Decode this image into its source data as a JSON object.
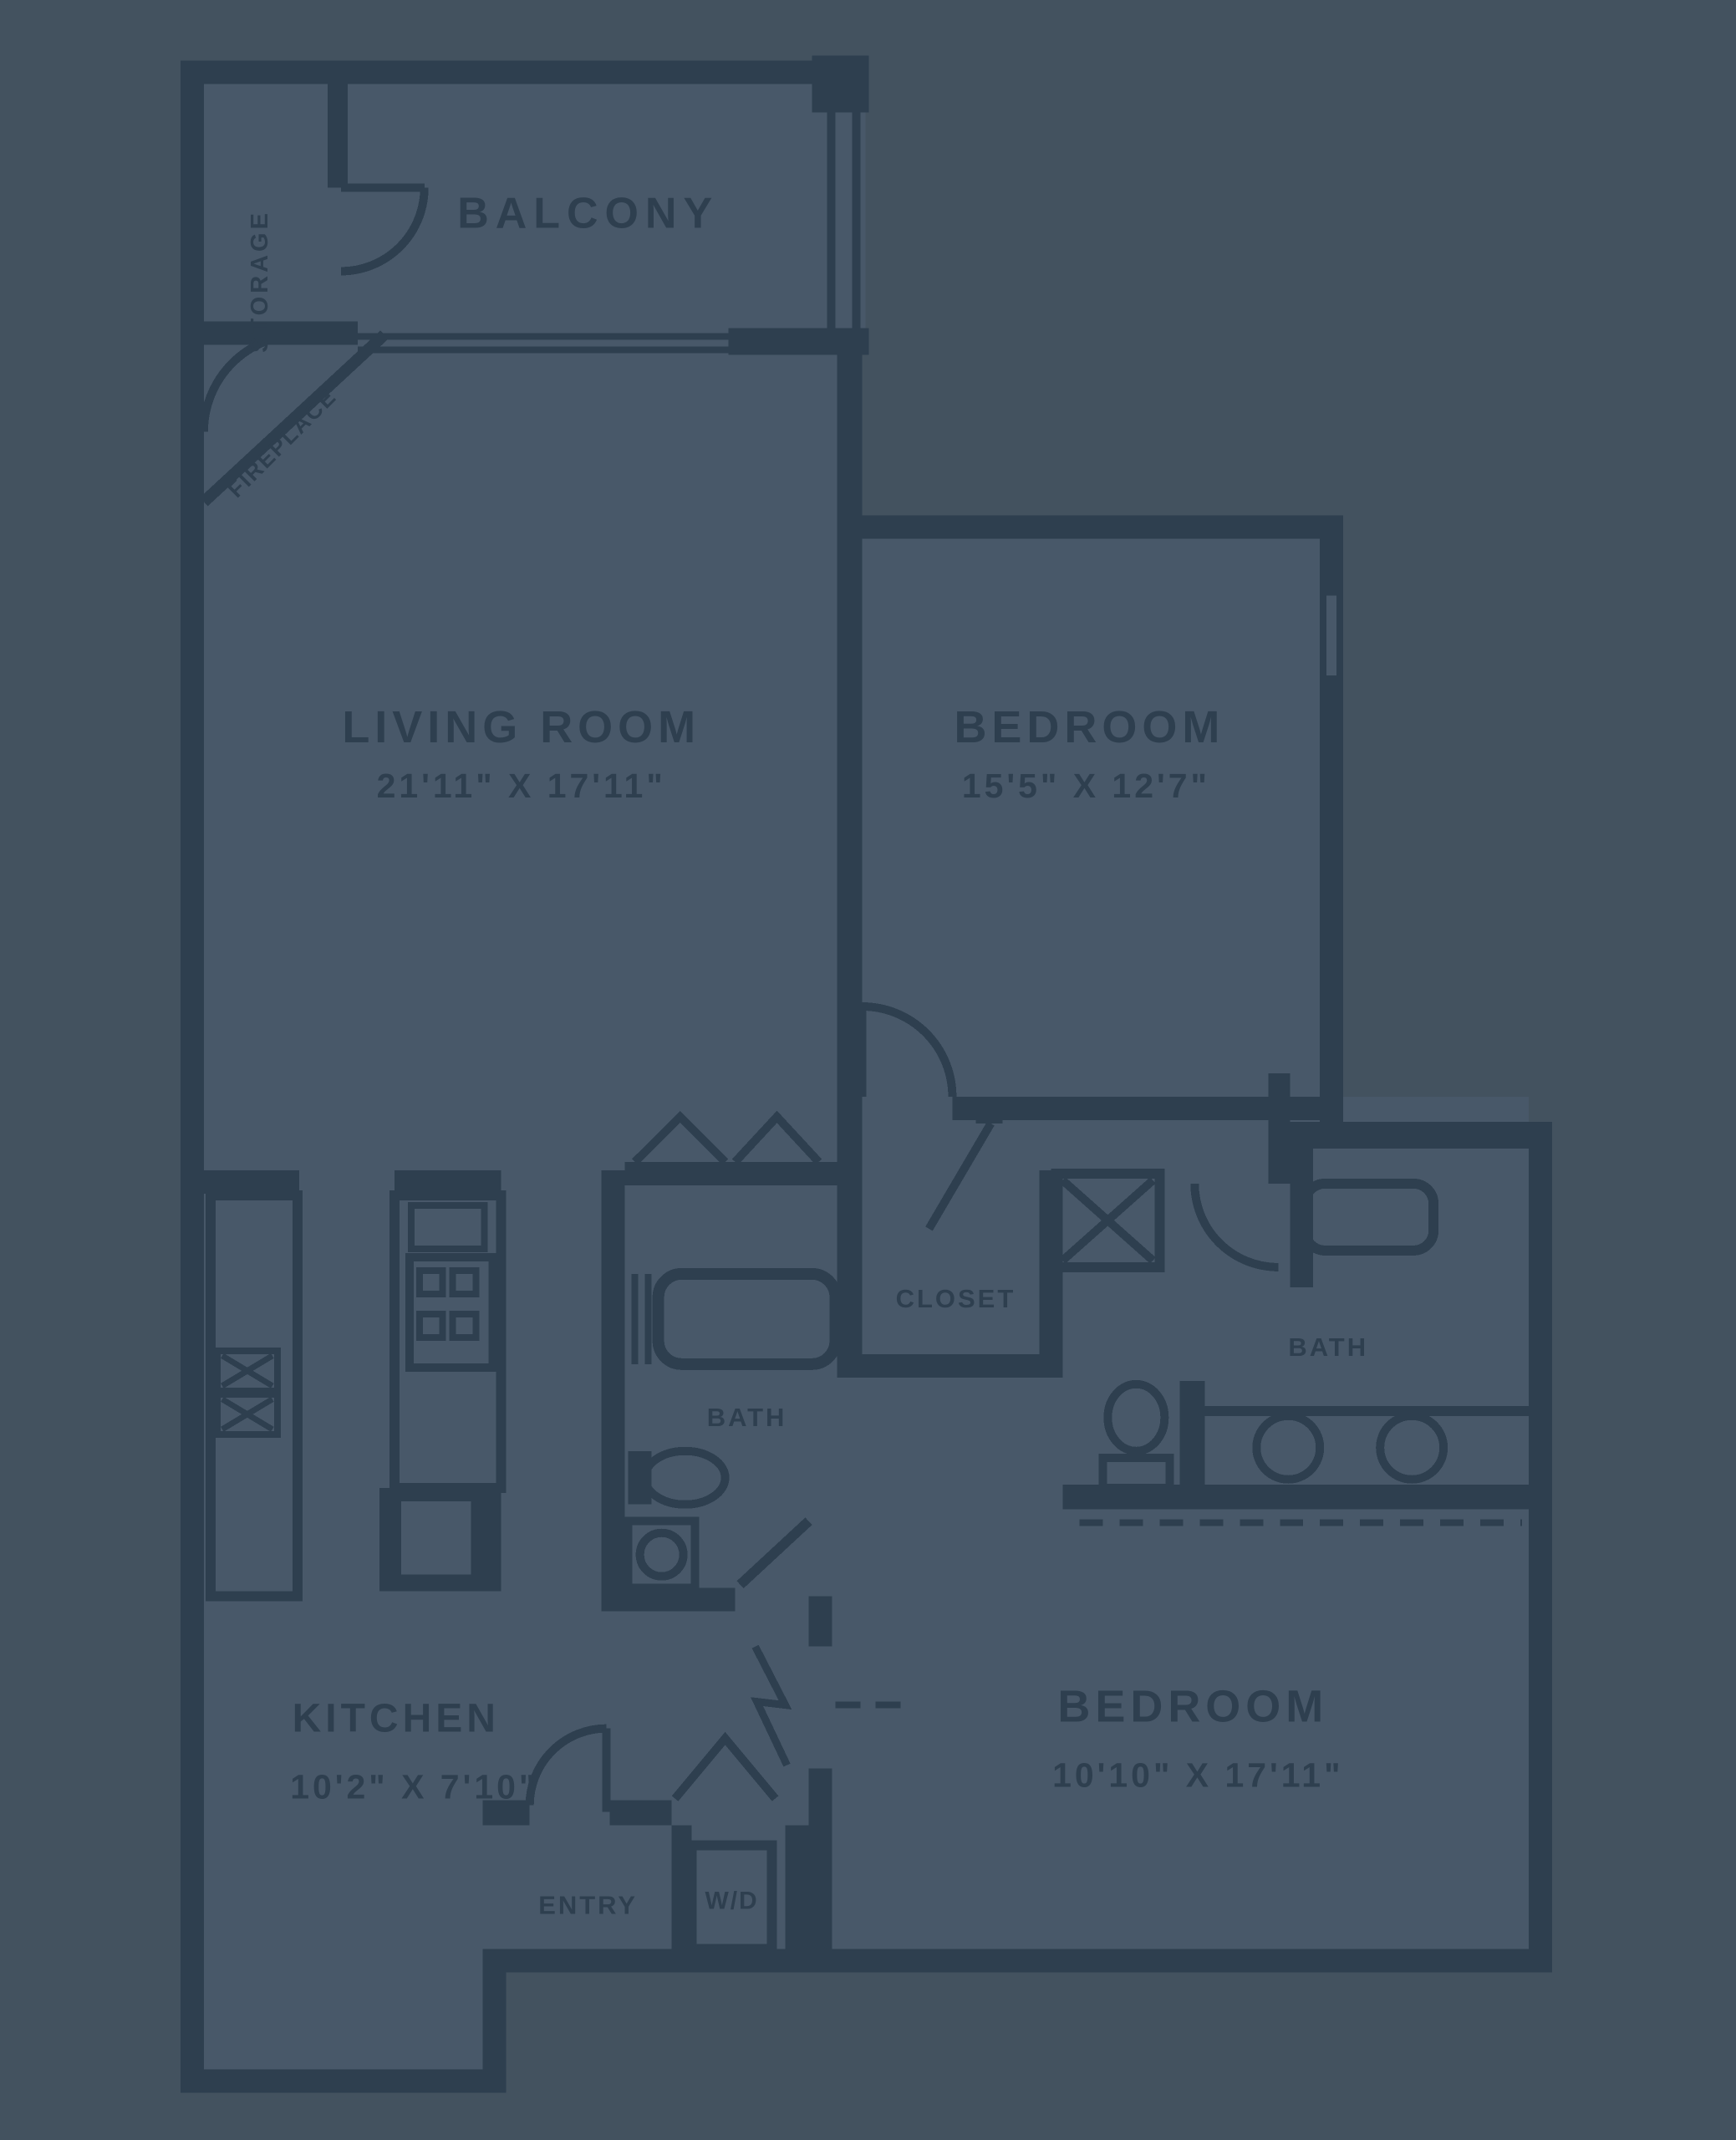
{
  "colors": {
    "background": "#43525f",
    "room_interior": "#485869",
    "wall": "#2e3f4f",
    "text": "#2e3f4f"
  },
  "plan": {
    "balcony": {
      "label": "BALCONY"
    },
    "storage": {
      "label": "STORAGE"
    },
    "fireplace": {
      "label": "FIREPLACE"
    },
    "living_room": {
      "label": "LIVING ROOM",
      "dims": "21'11\" X 17'11\""
    },
    "bedroom_1": {
      "label": "BEDROOM",
      "dims": "15'5\" X 12'7\""
    },
    "bedroom_2": {
      "label": "BEDROOM",
      "dims": "10'10\" X 17'11\""
    },
    "kitchen": {
      "label": "KITCHEN",
      "dims": "10'2\" X 7'10\""
    },
    "bath_1": {
      "label": "BATH"
    },
    "bath_2": {
      "label": "BATH"
    },
    "closet": {
      "label": "CLOSET"
    },
    "entry": {
      "label": "ENTRY"
    },
    "washer_dryer": {
      "label": "W/D"
    }
  },
  "fixtures": [
    "fireplace-corner",
    "bathtub-bath-1",
    "bathtub-bath-2",
    "toilet-bath-1",
    "toilet-bath-2",
    "sink-bath-1",
    "double-vanity-sinks",
    "kitchen-sink",
    "stove-burners",
    "kitchen-island",
    "kitchen-counter",
    "linen-cabinet-x",
    "washer-dryer-unit",
    "window-bedroom-1",
    "balcony-railing",
    "sliding-door"
  ]
}
